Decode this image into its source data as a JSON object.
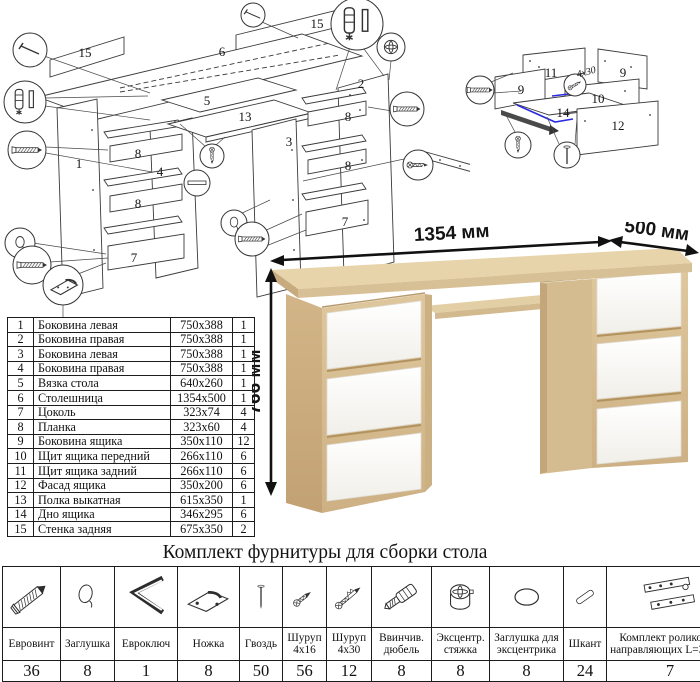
{
  "parts_table": {
    "rows": [
      {
        "num": "1",
        "name": "Боковина левая",
        "size": "750х388",
        "qty": "1"
      },
      {
        "num": "2",
        "name": "Боковина правая",
        "size": "750х388",
        "qty": "1"
      },
      {
        "num": "3",
        "name": "Боковина левая",
        "size": "750х388",
        "qty": "1"
      },
      {
        "num": "4",
        "name": "Боковина правая",
        "size": "750х388",
        "qty": "1"
      },
      {
        "num": "5",
        "name": "Вязка стола",
        "size": "640х260",
        "qty": "1"
      },
      {
        "num": "6",
        "name": "Столешница",
        "size": "1354х500",
        "qty": "1"
      },
      {
        "num": "7",
        "name": "Цоколь",
        "size": "323х74",
        "qty": "4"
      },
      {
        "num": "8",
        "name": "Планка",
        "size": "323х60",
        "qty": "4"
      },
      {
        "num": "9",
        "name": "Боковина ящика",
        "size": "350х110",
        "qty": "12"
      },
      {
        "num": "10",
        "name": "Щит ящика передний",
        "size": "266х110",
        "qty": "6"
      },
      {
        "num": "11",
        "name": "Щит ящика задний",
        "size": "266х110",
        "qty": "6"
      },
      {
        "num": "12",
        "name": "Фасад ящика",
        "size": "350х200",
        "qty": "6"
      },
      {
        "num": "13",
        "name": "Полка выкатная",
        "size": "615х350",
        "qty": "1"
      },
      {
        "num": "14",
        "name": "Дно ящика",
        "size": "346х295",
        "qty": "6"
      },
      {
        "num": "15",
        "name": "Стенка задняя",
        "size": "675х350",
        "qty": "2"
      }
    ]
  },
  "hardware": {
    "title": "Комплект фурнитуры для сборки стола",
    "items": [
      {
        "name": "Евровинт",
        "qty": "36",
        "icon": "confirmat-screw"
      },
      {
        "name": "Заглушка",
        "qty": "8",
        "icon": "cap"
      },
      {
        "name": "Евроключ",
        "qty": "1",
        "icon": "hex-key"
      },
      {
        "name": "Ножка",
        "qty": "8",
        "icon": "foot"
      },
      {
        "name": "Гвоздь",
        "qty": "50",
        "icon": "nail"
      },
      {
        "name": "Шуруп 4х16",
        "qty": "56",
        "icon": "screw-small"
      },
      {
        "name": "Шуруп 4х30",
        "qty": "12",
        "icon": "screw-long"
      },
      {
        "name": "Ввинчив. дюбель",
        "qty": "8",
        "icon": "screw-in-dowel"
      },
      {
        "name": "Эксцентр. стяжка",
        "qty": "8",
        "icon": "cam-lock"
      },
      {
        "name": "Заглушка для эксцентрика",
        "qty": "8",
        "icon": "cam-cap"
      },
      {
        "name": "Шкант",
        "qty": "24",
        "icon": "wood-dowel"
      },
      {
        "name": "Комплект роликовых направляющих L=350мм",
        "qty": "7",
        "icon": "drawer-slides"
      }
    ]
  },
  "desk": {
    "dim_width": "1354 мм",
    "dim_depth": "500 мм",
    "dim_height": "766 мм"
  },
  "main_diagram": {
    "labels": [
      "15",
      "6",
      "15",
      "2",
      "5",
      "13",
      "3",
      "8",
      "1",
      "8",
      "4",
      "8",
      "7",
      "8",
      "7"
    ]
  },
  "drawer_diagram": {
    "labels": [
      "11",
      "9",
      "9",
      "10",
      "14",
      "12"
    ],
    "screw_note": "4х30"
  }
}
